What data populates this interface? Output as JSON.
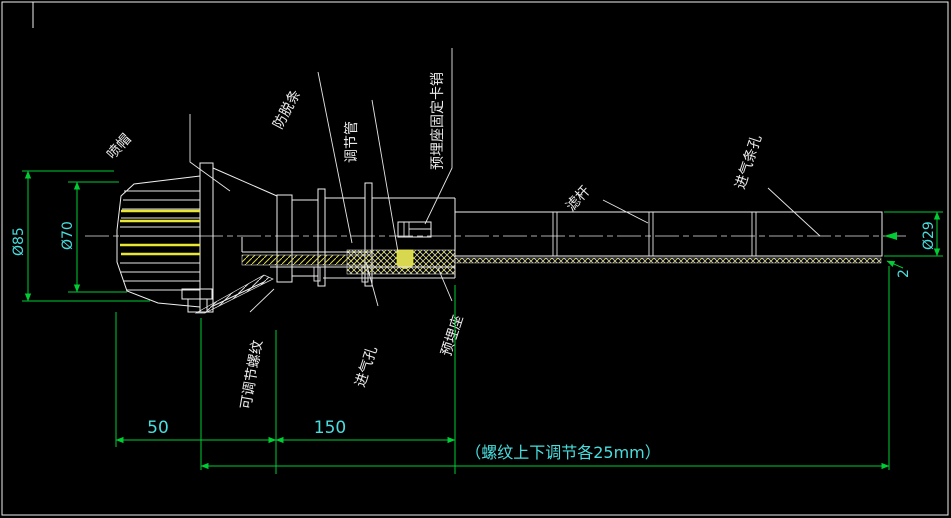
{
  "drawing": {
    "part_labels": {
      "spray_cap": "喷帽",
      "anti_slip_strip": "防脱条",
      "adjusting_tube": "调节管",
      "seat_fixing_pin": "预埋座固定卡销",
      "filter_rod": "滤杆",
      "air_inlet_slot": "进气条孔",
      "adjustable_thread": "可调节螺纹",
      "air_inlet_hole": "进气孔",
      "embedded_seat": "预埋座"
    },
    "dimensions": {
      "outer_diameter": "Ø85",
      "inner_diameter": "Ø70",
      "cap_length": "50",
      "body_length": "150",
      "rod_diameter": "Ø29",
      "wall_thickness": "2",
      "adjustment_note": "（螺纹上下调节各25mm）"
    },
    "colors": {
      "background": "#000000",
      "outline": "#f0f0f0",
      "dimension_line": "#00cc33",
      "dimension_text": "#49dede",
      "highlight": "#e8e832"
    }
  }
}
